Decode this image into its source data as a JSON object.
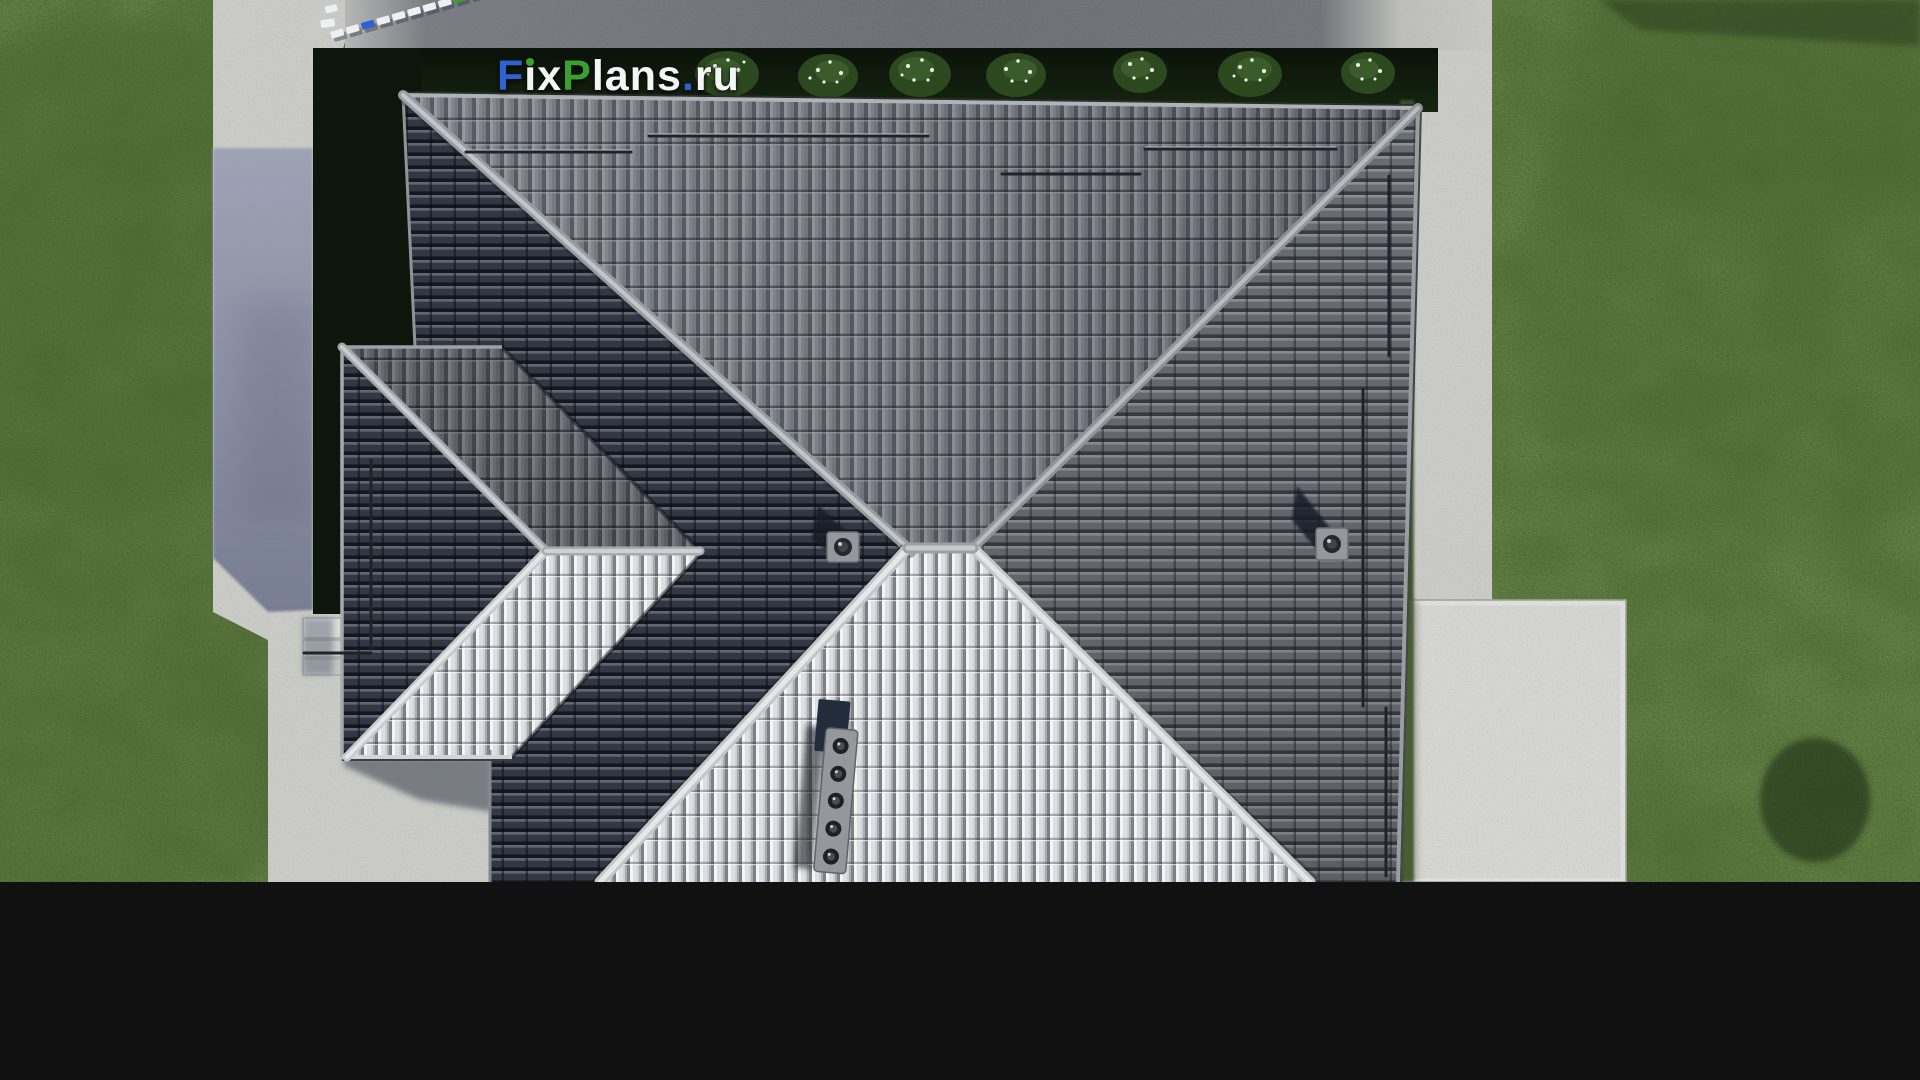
{
  "watermark": {
    "full_text": "FixPlans.ru",
    "part_f": "F",
    "part_ix": "ix",
    "part_p": "P",
    "part_lans": "lans",
    "part_dot": ".",
    "part_ru": "ru"
  },
  "scene": {
    "type": "aerial-3d-architectural-render",
    "subject": "top-down view of a house with gray hip tile roof",
    "labels": {
      "lawn": "lawn",
      "driveway": "driveway (top, in shadow)",
      "walkway": "left walkway",
      "patio": "patio (bottom right)",
      "hedge": "shadowed hedge with flowering bushes",
      "main_roof": "main hip roof",
      "wing_roof": "left wing hip roof",
      "south_slope": "sunlit south slope",
      "chimney_center": "chimney (center)",
      "chimney_right": "chimney (right slope)",
      "vent_stack": "multi-cap vent stack",
      "entry_steps": "entry steps",
      "logo_object": "3D logo letters seen from above"
    },
    "counts": {
      "hedge_bushes": 7,
      "vent_stack_caps": 5,
      "snow_guard_rows_top_slope": 4,
      "snow_guard_rails_right_slope": 3,
      "wing_guard_rails": 2
    }
  },
  "colors": {
    "grass_base": "#5e7c3e",
    "grass_dark": "#46622d",
    "hedge_dark": "#0d160b",
    "concrete_light": "#cdcec9",
    "concrete_bright": "#d8d9d5",
    "path_shadow": "#8a90a5",
    "driveway_shade": "#6e7178",
    "roof_dark": "#343845",
    "roof_mid": "#6e727a",
    "roof_bright": "#ccced1",
    "ridge_light": "#a8acb1",
    "guard_dark": "#1e222a",
    "metal_plate": "#94989d",
    "shadow_navy": "#2c3342",
    "logo_blue": "#2e62d0",
    "logo_green": "#3ba02f",
    "logo_white": "#f4f5f7"
  }
}
